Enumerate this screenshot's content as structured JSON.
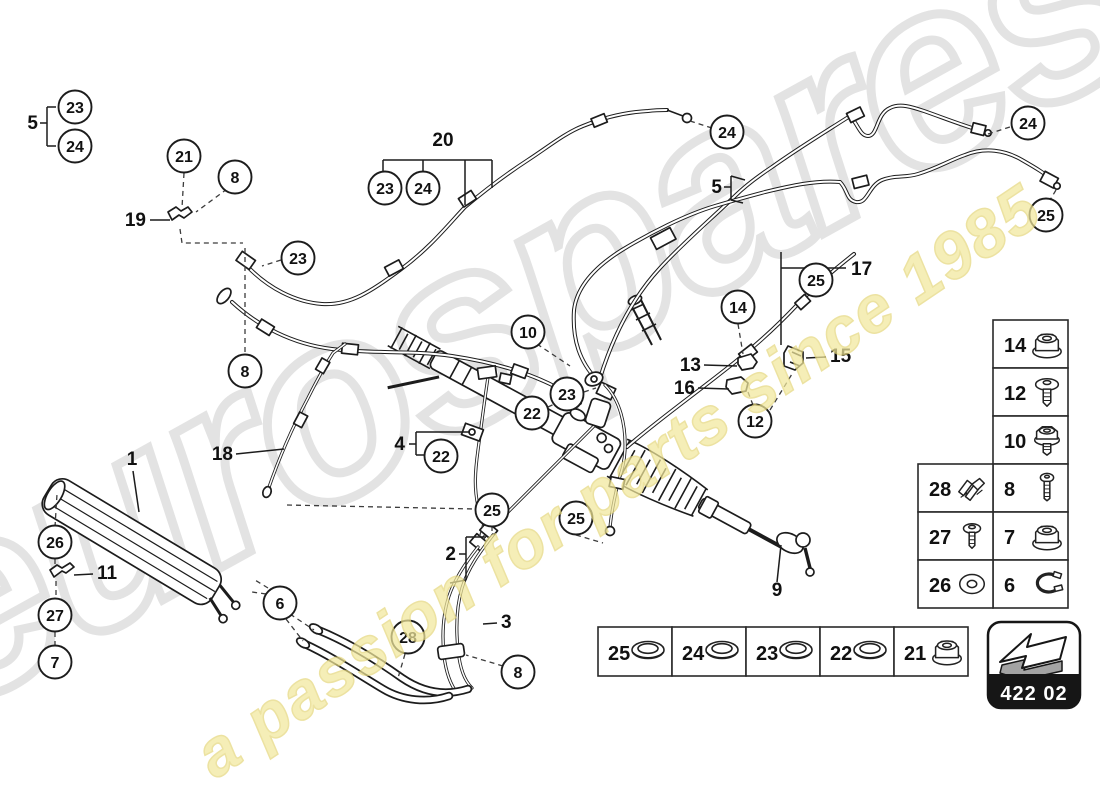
{
  "watermark": {
    "brand": "eurospares",
    "tagline": "a passion for parts since 1985",
    "brand_color": "#e3e3e3",
    "tagline_color": "#f2e89c"
  },
  "badge": {
    "code": "422 02",
    "bg_color": "#161616"
  },
  "circles": [
    "23",
    "24",
    "21",
    "8",
    "23",
    "23",
    "24",
    "24",
    "24",
    "25",
    "25",
    "14",
    "10",
    "23",
    "22",
    "12",
    "22",
    "25",
    "25",
    "8",
    "26",
    "27",
    "7",
    "6",
    "28",
    "8"
  ],
  "labels": [
    "5",
    "19",
    "20",
    "5",
    "17",
    "13",
    "16",
    "15",
    "1",
    "18",
    "11",
    "4",
    "2",
    "3",
    "9"
  ],
  "legend": {
    "col_right": [
      "14",
      "12",
      "10",
      "8",
      "7",
      "6"
    ],
    "col_left": [
      "28",
      "27",
      "26"
    ],
    "strip": [
      "25",
      "24",
      "23",
      "22",
      "21"
    ]
  },
  "icon_names": {
    "col_right": [
      "flange-nut-icon",
      "dome-screw-icon",
      "collar-nut-icon",
      "bolt-icon",
      "flange-nut-icon",
      "clamp-icon"
    ],
    "col_left": [
      "spring-clip-icon",
      "pan-screw-icon",
      "washer-icon"
    ],
    "strip": [
      "seal-ring-icon",
      "seal-ring-icon",
      "seal-ring-icon",
      "seal-ring-icon",
      "flange-nut-icon"
    ],
    "badge": "prev-diagram-arrow-icon"
  },
  "art_color": "#1c1c1c"
}
